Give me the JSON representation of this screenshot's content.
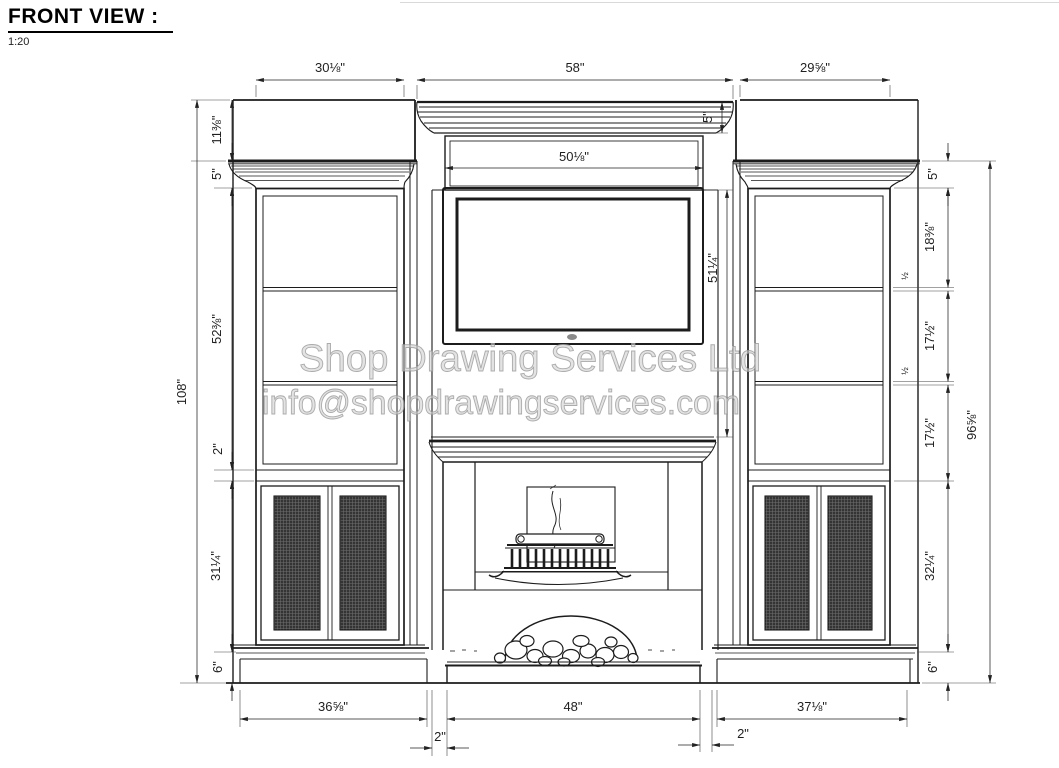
{
  "title": "FRONT VIEW :",
  "scale_label": "1:20",
  "watermark": {
    "line1": "Shop Drawing Services Ltd",
    "line2": "info@shopdrawingservices.com"
  },
  "dims": {
    "top": {
      "left": "30⅛\"",
      "center": "58\"",
      "right": "29⅝\"",
      "frieze": "50⅛\"",
      "crown": "5\""
    },
    "left": {
      "overall": "108\"",
      "band": "11⅜\"",
      "crown": "5\"",
      "upper": "52⅜\"",
      "rail": "2\"",
      "doors": "31¼\"",
      "base": "6\""
    },
    "right": {
      "crown": "5\"",
      "shelf_top": "18⅜\"",
      "shelf_thickness": "½",
      "shelf_mid": "17½\"",
      "shelf_thickness2": "½",
      "shelf_bot": "17½\"",
      "doors": "32¼\"",
      "base": "6\"",
      "face": "96⅝\""
    },
    "center": {
      "tv": "51¼\""
    },
    "bottom": {
      "left": "36⅝\"",
      "gap_left": "2\"",
      "hearth": "48\"",
      "gap_right": "2\"",
      "right": "37⅛\""
    }
  }
}
